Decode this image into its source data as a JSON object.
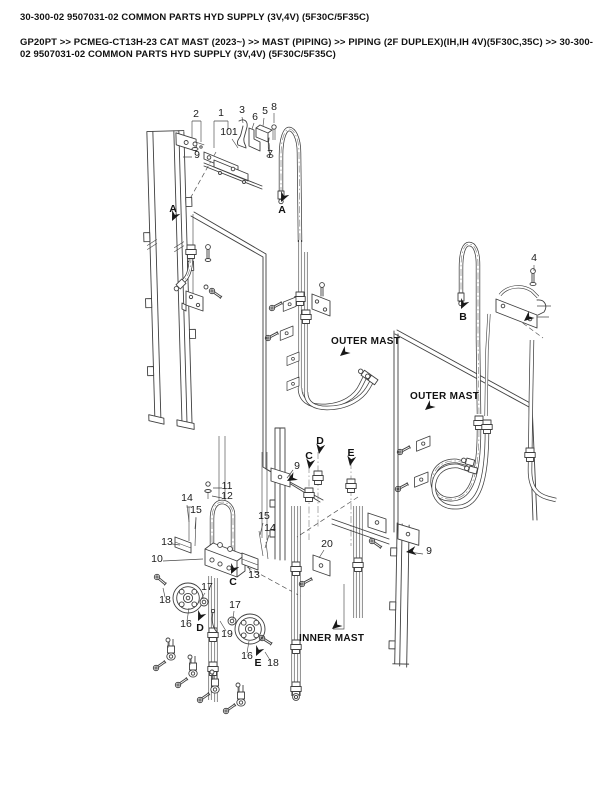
{
  "page": {
    "title": "30-300-02 9507031-02 COMMON PARTS HYD SUPPLY (3V,4V) (5F30C/5F35C)",
    "breadcrumb": "GP20PT >> PCMEG-CT13H-23 CAT MAST (2023~) >> MAST (PIPING) >> PIPING (2F DUPLEX)(IH,IH 4V)(5F30C,35C) >> 30-300-02 9507031-02 COMMON PARTS HYD SUPPLY (3V,4V) (5F30C/5F35C)"
  },
  "diagram": {
    "ink": "#3f3f3f",
    "callouts": [
      {
        "t": "2",
        "x": 196,
        "y": 117
      },
      {
        "t": "1",
        "x": 221,
        "y": 116
      },
      {
        "t": "3",
        "x": 242,
        "y": 113
      },
      {
        "t": "101",
        "x": 229,
        "y": 135
      },
      {
        "t": "6",
        "x": 255,
        "y": 120
      },
      {
        "t": "5",
        "x": 265,
        "y": 114
      },
      {
        "t": "8",
        "x": 274,
        "y": 110
      },
      {
        "t": "7",
        "x": 270,
        "y": 157
      },
      {
        "t": "9",
        "x": 197,
        "y": 158
      },
      {
        "t": "4",
        "x": 534,
        "y": 261
      },
      {
        "t": "11",
        "x": 227,
        "y": 489
      },
      {
        "t": "12",
        "x": 227,
        "y": 499
      },
      {
        "t": "14",
        "x": 187,
        "y": 501
      },
      {
        "t": "15",
        "x": 196,
        "y": 513
      },
      {
        "t": "13",
        "x": 167,
        "y": 545
      },
      {
        "t": "15",
        "x": 264,
        "y": 519
      },
      {
        "t": "14",
        "x": 270,
        "y": 531
      },
      {
        "t": "9",
        "x": 297,
        "y": 469
      },
      {
        "t": "10",
        "x": 157,
        "y": 562
      },
      {
        "t": "13",
        "x": 254,
        "y": 578
      },
      {
        "t": "17",
        "x": 207,
        "y": 590
      },
      {
        "t": "18",
        "x": 165,
        "y": 603
      },
      {
        "t": "16",
        "x": 186,
        "y": 627
      },
      {
        "t": "17",
        "x": 235,
        "y": 608
      },
      {
        "t": "19",
        "x": 227,
        "y": 637
      },
      {
        "t": "16",
        "x": 247,
        "y": 659
      },
      {
        "t": "18",
        "x": 273,
        "y": 666
      },
      {
        "t": "20",
        "x": 327,
        "y": 547
      },
      {
        "t": "9",
        "x": 429,
        "y": 554
      }
    ],
    "annotations": [
      {
        "t": "A",
        "x": 173,
        "y": 212,
        "ax": 172,
        "ay": 221,
        "ang": 115,
        "kind": "ref"
      },
      {
        "t": "A",
        "x": 282,
        "y": 213,
        "ax": 281,
        "ay": 202,
        "ang": 115,
        "kind": "ref"
      },
      {
        "t": "B",
        "x": 463,
        "y": 320,
        "ax": 461,
        "ay": 309,
        "ang": 115,
        "kind": "ref"
      },
      {
        "t": "C",
        "x": 309,
        "y": 459,
        "ax": 309,
        "ay": 469,
        "ang": 100,
        "kind": "ref"
      },
      {
        "t": "D",
        "x": 320,
        "y": 444,
        "ax": 319,
        "ay": 454,
        "ang": 100,
        "kind": "ref"
      },
      {
        "t": "E",
        "x": 351,
        "y": 456,
        "ax": 350,
        "ay": 466,
        "ang": 100,
        "kind": "ref"
      },
      {
        "t": "C",
        "x": 233,
        "y": 585,
        "ax": 231,
        "ay": 574,
        "ang": 115,
        "kind": "ref"
      },
      {
        "t": "D",
        "x": 200,
        "y": 631,
        "ax": 198,
        "ay": 621,
        "ang": 115,
        "kind": "ref"
      },
      {
        "t": "E",
        "x": 258,
        "y": 666,
        "ax": 256,
        "ay": 656,
        "ang": 115,
        "kind": "ref"
      },
      {
        "t": "OUTER MAST",
        "x": 331,
        "y": 344,
        "ax": 340,
        "ay": 356,
        "ang": 140,
        "kind": "area"
      },
      {
        "t": "OUTER MAST",
        "x": 410,
        "y": 399,
        "ax": 425,
        "ay": 410,
        "ang": 140,
        "kind": "area"
      },
      {
        "t": "INNER MAST",
        "x": 299,
        "y": 641,
        "ax": 332,
        "ay": 629,
        "ang": 140,
        "kind": "area"
      },
      {
        "t": "",
        "x": 0,
        "y": 0,
        "ax": 524,
        "ay": 321,
        "ang": 140,
        "kind": "arrow"
      },
      {
        "t": "",
        "x": 0,
        "y": 0,
        "ax": 406,
        "ay": 552,
        "ang": 172,
        "kind": "arrow"
      },
      {
        "t": "",
        "x": 0,
        "y": 0,
        "ax": 287,
        "ay": 481,
        "ang": 150,
        "kind": "arrow"
      }
    ]
  }
}
